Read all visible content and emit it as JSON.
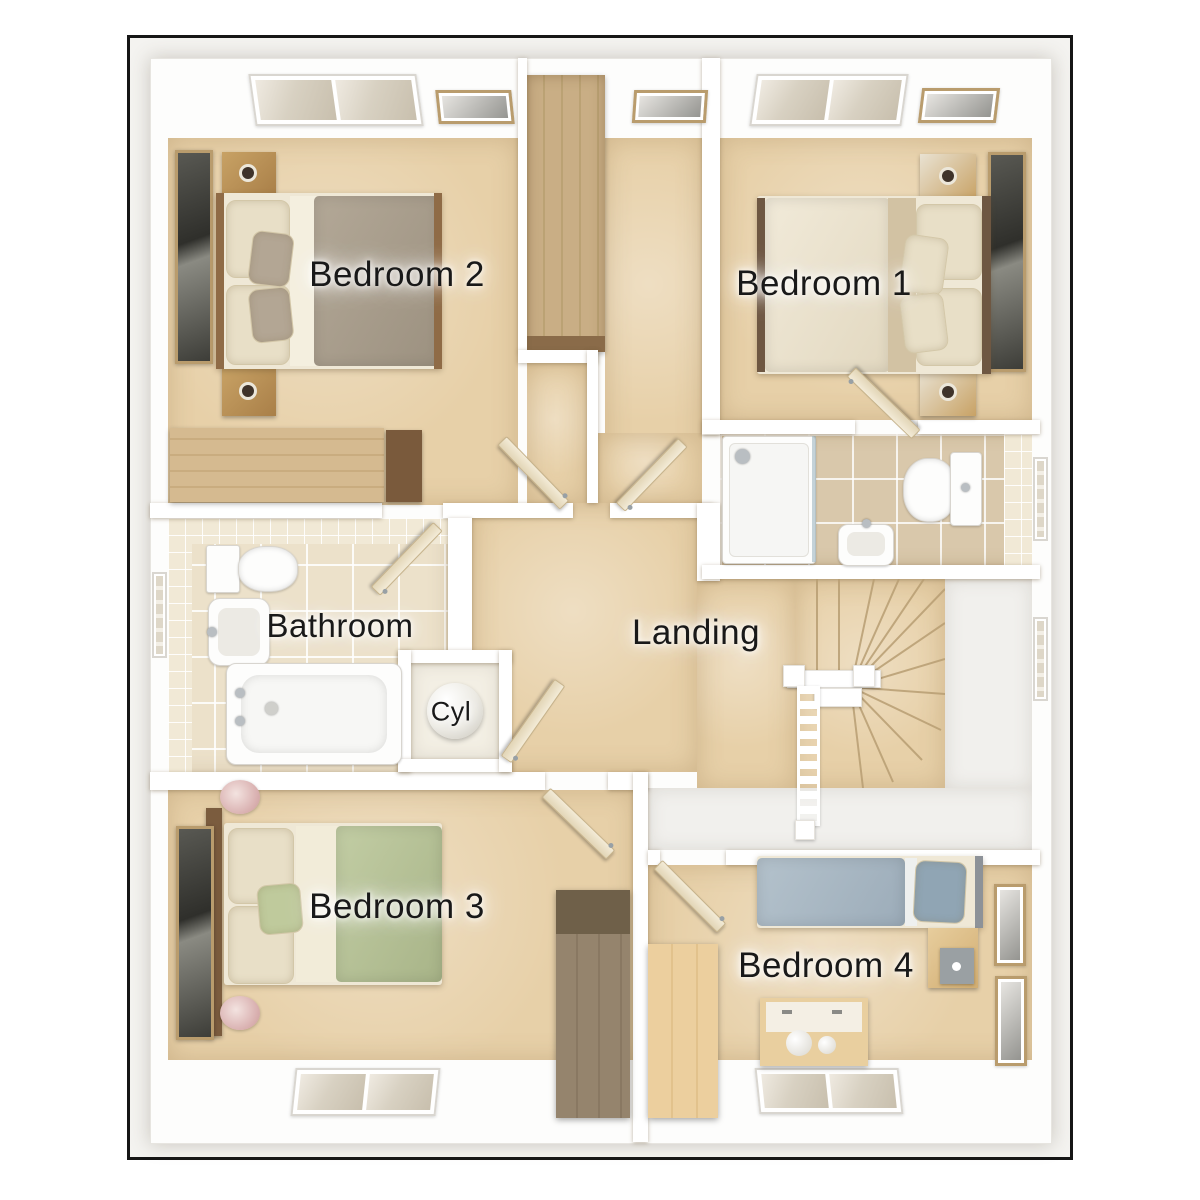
{
  "plan_title": "First floor plan",
  "rooms": {
    "bedroom1": {
      "label": "Bedroom 1"
    },
    "bedroom2": {
      "label": "Bedroom 2"
    },
    "bedroom3": {
      "label": "Bedroom 3"
    },
    "bedroom4": {
      "label": "Bedroom 4"
    },
    "bathroom": {
      "label": "Bathroom"
    },
    "landing": {
      "label": "Landing"
    },
    "cylinder_cupboard": {
      "label": "Cyl"
    }
  },
  "palette": {
    "frame_border": "#161616",
    "wall": "#ffffff",
    "carpet": "#e7d0a8",
    "white_floor": "#f1f0ed",
    "bathroom_tile": "#ece1ca",
    "ensuite_tile": "#d9c8ab",
    "wood_light": "#c9ae85",
    "wood_dark": "#7b5c3e",
    "duvet_bedroom1": "#ece4d1",
    "duvet_bedroom2": "#a89d8c",
    "duvet_bedroom3": "#b5c197",
    "duvet_bedroom4": "#a9b9c3",
    "label_color": "#191919"
  }
}
